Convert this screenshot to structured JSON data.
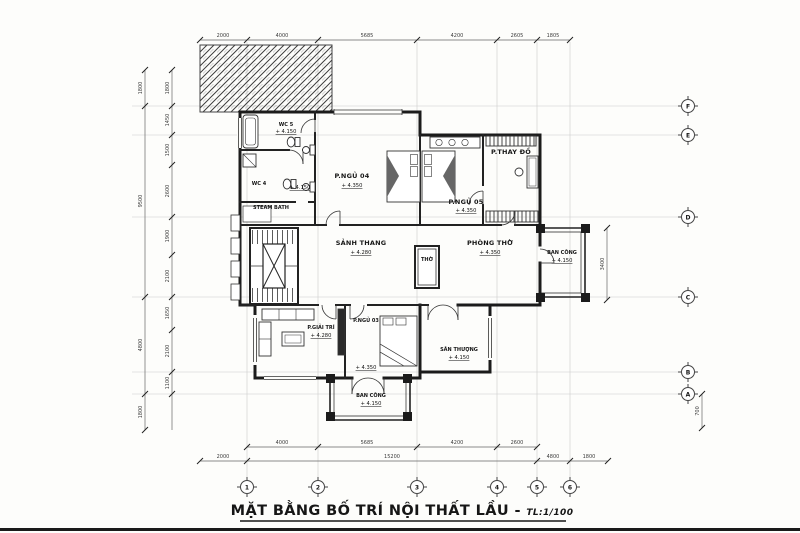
{
  "title": {
    "main": "MẶT BẰNG BỐ TRÍ NỘI THẤT LẦU - ",
    "scale": "TL:1/100"
  },
  "grid": {
    "columns": [
      "1",
      "2",
      "3",
      "4",
      "5",
      "6"
    ],
    "rows": [
      "F",
      "E",
      "D",
      "C",
      "B",
      "A"
    ]
  },
  "rooms": [
    {
      "name": "WC 5",
      "elev": "+ 4.150"
    },
    {
      "name": "WC 4",
      "elev": "+ 4.150"
    },
    {
      "name": "STEAM BATH",
      "elev": ""
    },
    {
      "name": "P.NGỦ 04",
      "elev": "+ 4.350"
    },
    {
      "name": "P.NGỦ 05",
      "elev": "+ 4.350"
    },
    {
      "name": "P.THAY ĐỒ",
      "elev": ""
    },
    {
      "name": "SẢNH THANG",
      "elev": "+ 4.280"
    },
    {
      "name": "PHÒNG THỜ",
      "elev": "+ 4.350"
    },
    {
      "name": "THỜ",
      "elev": ""
    },
    {
      "name": "BAN CÔNG",
      "elev": "+ 4.150"
    },
    {
      "name": "P.GIẢI TRÍ",
      "elev": "+ 4.280"
    },
    {
      "name": "P.NGỦ 03",
      "elev": "+ 4.350"
    },
    {
      "name": "SÂN THƯỢNG",
      "elev": "+ 4.150"
    },
    {
      "name": "BAN CÔNG",
      "elev": "+ 4.150"
    }
  ],
  "dimensions": {
    "top": [
      "2000",
      "4000",
      "5685",
      "4200",
      "2605",
      "1805"
    ],
    "bottom_inner": [
      "4000",
      "5685",
      "4200",
      "2600"
    ],
    "bottom_outer": [
      "2000",
      "15200",
      "4800",
      "1800"
    ],
    "left_outer": [
      "1800",
      "9500",
      "4800",
      "1800"
    ],
    "left_inner": [
      "1800",
      "1450",
      "1500",
      "2600",
      "1900",
      "2100",
      "1650",
      "2100",
      "1100"
    ],
    "right": [
      "3400",
      "700"
    ]
  },
  "colors": {
    "wall": "#1b1b1b",
    "thin_line": "#333333",
    "construction": "#cccccc",
    "dim_line": "#666666",
    "paper": "#fdfdfb"
  }
}
